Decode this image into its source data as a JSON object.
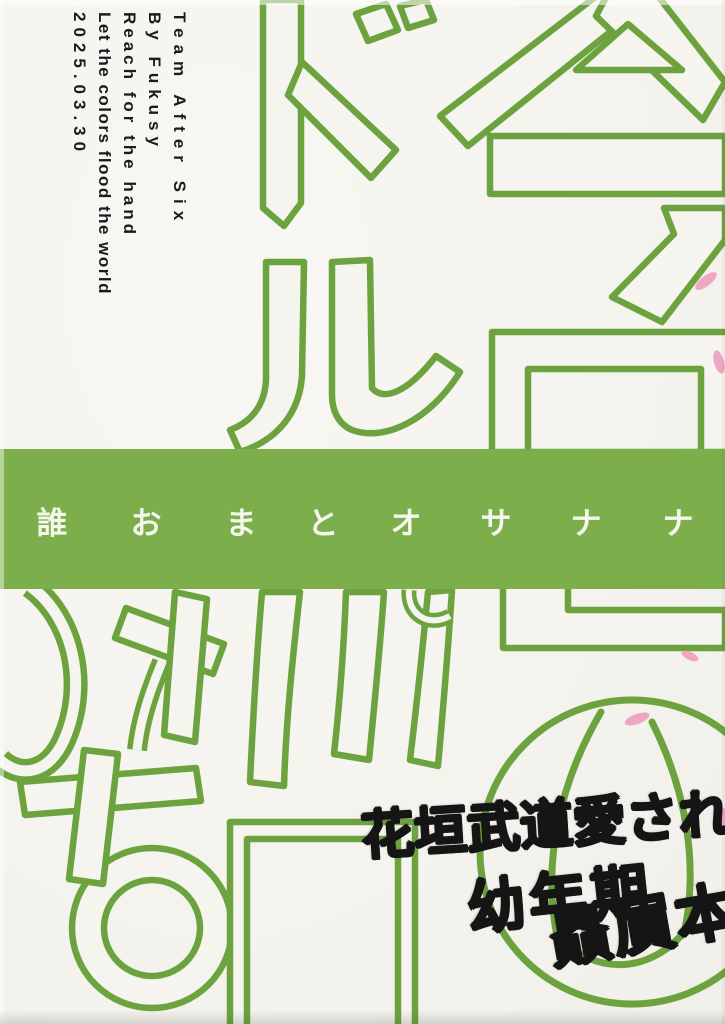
{
  "page": {
    "kind": "doujinshi back cover scan"
  },
  "info_block": {
    "lines": [
      "Team After Six",
      "By Fukusy",
      "Reach for the hand",
      "Let the colors flood the world",
      "2025.03.30"
    ]
  },
  "obi_band": {
    "chars": [
      "誰",
      "お",
      "ま",
      "と",
      "オ",
      "サ",
      "ナ",
      "ナ"
    ]
  },
  "handwritten_note": {
    "lines": [
      "花垣武道愛され",
      "幼年期",
      "贔屓本"
    ]
  },
  "title_outline_glyphs": {
    "visible": [
      "今",
      "日",
      "ド",
      "ル",
      "バ",
      "の",
      "ち",
      "日",
      "ゆ"
    ]
  },
  "colors": {
    "band_green": "#7caf4b",
    "outline_green": "#6da33f",
    "petal_pink": "#efa6c2",
    "paper": "#f5f4ef",
    "band_text": "#f4f7ee",
    "marker_ink": "#151515",
    "info_ink": "#1b1b1e"
  }
}
